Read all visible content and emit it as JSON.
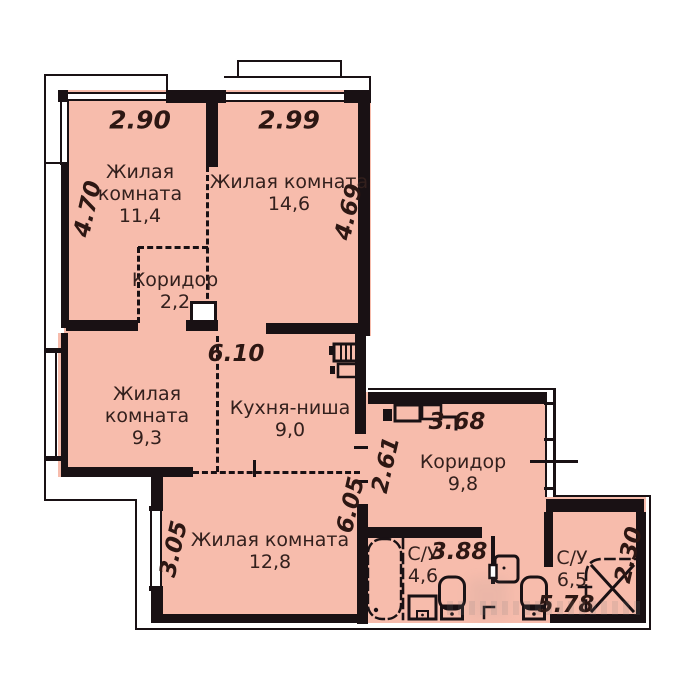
{
  "plan": {
    "background": "#ffffff",
    "room_fill": "#f7bcac",
    "wall_color": "#191114",
    "label_color": "#33201d",
    "dim_color": "#2d1713",
    "rooms": [
      {
        "id": "living-1",
        "name_lines": [
          "Жилая",
          "комната"
        ],
        "area": "11,4",
        "cx": 140,
        "top": 161
      },
      {
        "id": "living-2",
        "name_lines": [
          "Жилая комната"
        ],
        "area": "14,6",
        "cx": 289,
        "top": 171
      },
      {
        "id": "hall-1",
        "name_lines": [
          "Коридор"
        ],
        "area": "2,2",
        "cx": 175,
        "top": 269
      },
      {
        "id": "living-3",
        "name_lines": [
          "Жилая",
          "комната"
        ],
        "area": "9,3",
        "cx": 147,
        "top": 383
      },
      {
        "id": "kitchen",
        "name_lines": [
          "Кухня-ниша"
        ],
        "area": "9,0",
        "cx": 290,
        "top": 397
      },
      {
        "id": "hall-2",
        "name_lines": [
          "Коридор"
        ],
        "area": "9,8",
        "cx": 463,
        "top": 451
      },
      {
        "id": "living-4",
        "name_lines": [
          "Жилая комната"
        ],
        "area": "12,8",
        "cx": 270,
        "top": 529
      },
      {
        "id": "bath-1",
        "name_lines": [
          "С/У"
        ],
        "area": "4,6",
        "cx": 423,
        "top": 543
      },
      {
        "id": "bath-2",
        "name_lines": [
          "С/У"
        ],
        "area": "6,5",
        "cx": 572,
        "top": 547
      }
    ],
    "dimensions": [
      {
        "text": "2.90",
        "x": 140,
        "y": 120,
        "rot": 0,
        "size": 25
      },
      {
        "text": "2.99",
        "x": 289,
        "y": 120,
        "rot": 0,
        "size": 25
      },
      {
        "text": "4.70",
        "x": 88,
        "y": 209,
        "rot": -77,
        "size": 23
      },
      {
        "text": "4.69",
        "x": 349,
        "y": 212,
        "rot": -77,
        "size": 23
      },
      {
        "text": "6.10",
        "x": 236,
        "y": 354,
        "rot": 0,
        "size": 23
      },
      {
        "text": "3.68",
        "x": 457,
        "y": 422,
        "rot": 0,
        "size": 23
      },
      {
        "text": "2.61",
        "x": 386,
        "y": 465,
        "rot": -77,
        "size": 23
      },
      {
        "text": "6.05",
        "x": 351,
        "y": 505,
        "rot": -77,
        "size": 23
      },
      {
        "text": "3.05",
        "x": 174,
        "y": 549,
        "rot": -77,
        "size": 23
      },
      {
        "text": "3.88",
        "x": 459,
        "y": 552,
        "rot": 0,
        "size": 23
      },
      {
        "text": "5.78",
        "x": 566,
        "y": 605,
        "rot": 0,
        "size": 23
      },
      {
        "text": "2.30",
        "x": 629,
        "y": 555,
        "rot": -77,
        "size": 23
      }
    ],
    "fixtures": [
      "bathtub",
      "washing-machine",
      "pedestal-sink",
      "toilet",
      "water-heater",
      "shower-cabin",
      "kitchen-appliances",
      "hallway-cabinet",
      "vent-shaft"
    ]
  }
}
